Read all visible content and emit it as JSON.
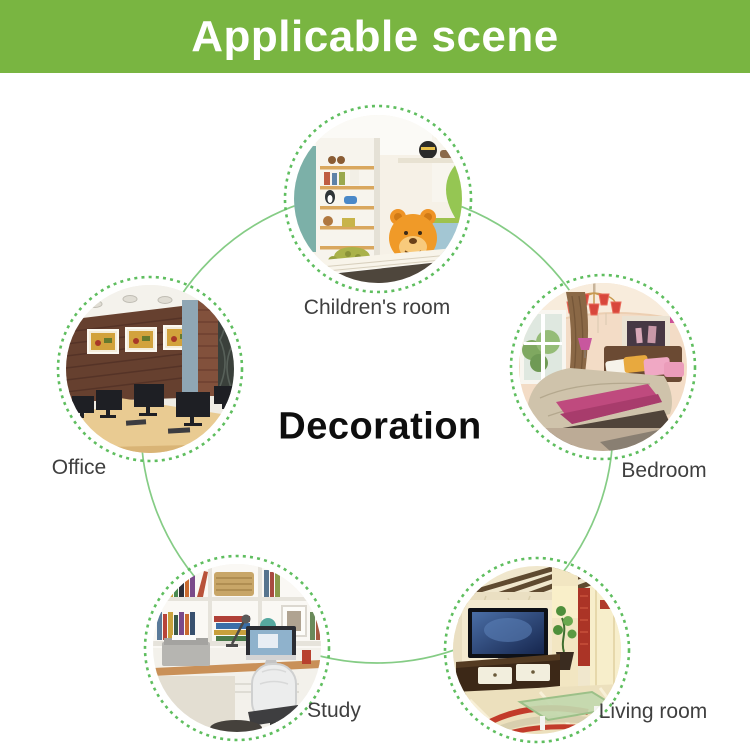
{
  "header": {
    "title": "Applicable scene"
  },
  "center": {
    "label": "Decoration"
  },
  "scenes": [
    {
      "id": "childrens-room",
      "label": "Children's room"
    },
    {
      "id": "office",
      "label": "Office"
    },
    {
      "id": "bedroom",
      "label": "Bedroom"
    },
    {
      "id": "study",
      "label": "Study"
    },
    {
      "id": "living-room",
      "label": "Living room"
    }
  ],
  "colors": {
    "banner_green": "#79b541",
    "banner_text": "#ffffff",
    "connector_circle_green": "#85cc85",
    "dotted_ring_green": "#5fbe5f",
    "scene_label_text": "#3f3f3f",
    "center_label_text": "#0e0e0e",
    "background": "#ffffff"
  }
}
